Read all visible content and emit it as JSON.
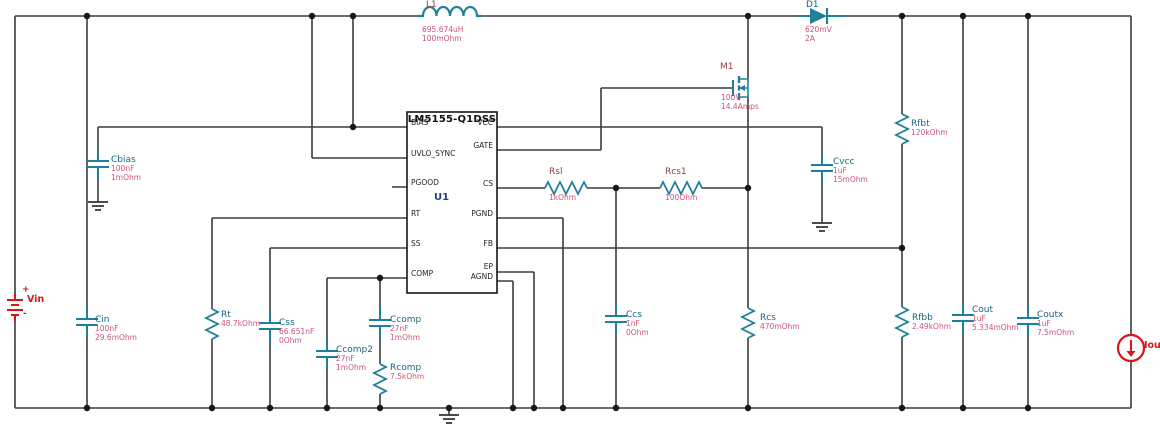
{
  "colors": {
    "wire": "#3c3c3c",
    "symbol_teal": "#20809a",
    "label_teal": "#16657f",
    "label_maroon": "#94403a",
    "value_pink": "#cc5577",
    "accent_red": "#d81616",
    "ic_refdes_blue": "#1f3f8f",
    "ic_border": "#161616"
  },
  "ic": {
    "title": "LM5155-Q1DSS",
    "refdes": "U1",
    "left_pins": [
      "BIAS",
      "UVLO_SYNC",
      "PGOOD",
      "RT",
      "SS",
      "COMP"
    ],
    "right_pins": [
      "VCC",
      "GATE",
      "CS",
      "PGND",
      "FB",
      "EP",
      "AGND"
    ]
  },
  "components": {
    "vin": {
      "name": "Vin",
      "plus": "+",
      "minus": "-"
    },
    "iout": {
      "name": "Iout"
    },
    "l1": {
      "name": "L1",
      "v1": "695.674uH",
      "v2": "100mOhm"
    },
    "d1": {
      "name": "D1",
      "v1": "620mV",
      "v2": "2A"
    },
    "m1": {
      "name": "M1",
      "v1": "100V",
      "v2": "14.4Amps"
    },
    "cin": {
      "name": "Cin",
      "v1": "100nF",
      "v2": "29.6mOhm"
    },
    "cbias": {
      "name": "Cbias",
      "v1": "100nF",
      "v2": "1mOhm"
    },
    "rt": {
      "name": "Rt",
      "v1": "48.7kOhm"
    },
    "css": {
      "name": "Css",
      "v1": "66.651nF",
      "v2": "0Ohm"
    },
    "ccomp2": {
      "name": "Ccomp2",
      "v1": "27nF",
      "v2": "1mOhm"
    },
    "ccomp": {
      "name": "Ccomp",
      "v1": "27nF",
      "v2": "1mOhm"
    },
    "rcomp": {
      "name": "Rcomp",
      "v1": "7.5kOhm"
    },
    "rsl": {
      "name": "Rsl",
      "v1": "1kOhm"
    },
    "rcs1": {
      "name": "Rcs1",
      "v1": "100Ohm"
    },
    "ccs": {
      "name": "Ccs",
      "v1": "1nF",
      "v2": "0Ohm"
    },
    "rcs": {
      "name": "Rcs",
      "v1": "470mOhm"
    },
    "cvcc": {
      "name": "Cvcc",
      "v1": "1uF",
      "v2": "15mOhm"
    },
    "rfbt": {
      "name": "Rfbt",
      "v1": "120kOhm"
    },
    "rfbb": {
      "name": "Rfbb",
      "v1": "2.49kOhm"
    },
    "cout": {
      "name": "Cout",
      "v1": "1uF",
      "v2": "5.334mOhm"
    },
    "coutx": {
      "name": "Coutx",
      "v1": "1uF",
      "v2": "7.5mOhm"
    }
  }
}
